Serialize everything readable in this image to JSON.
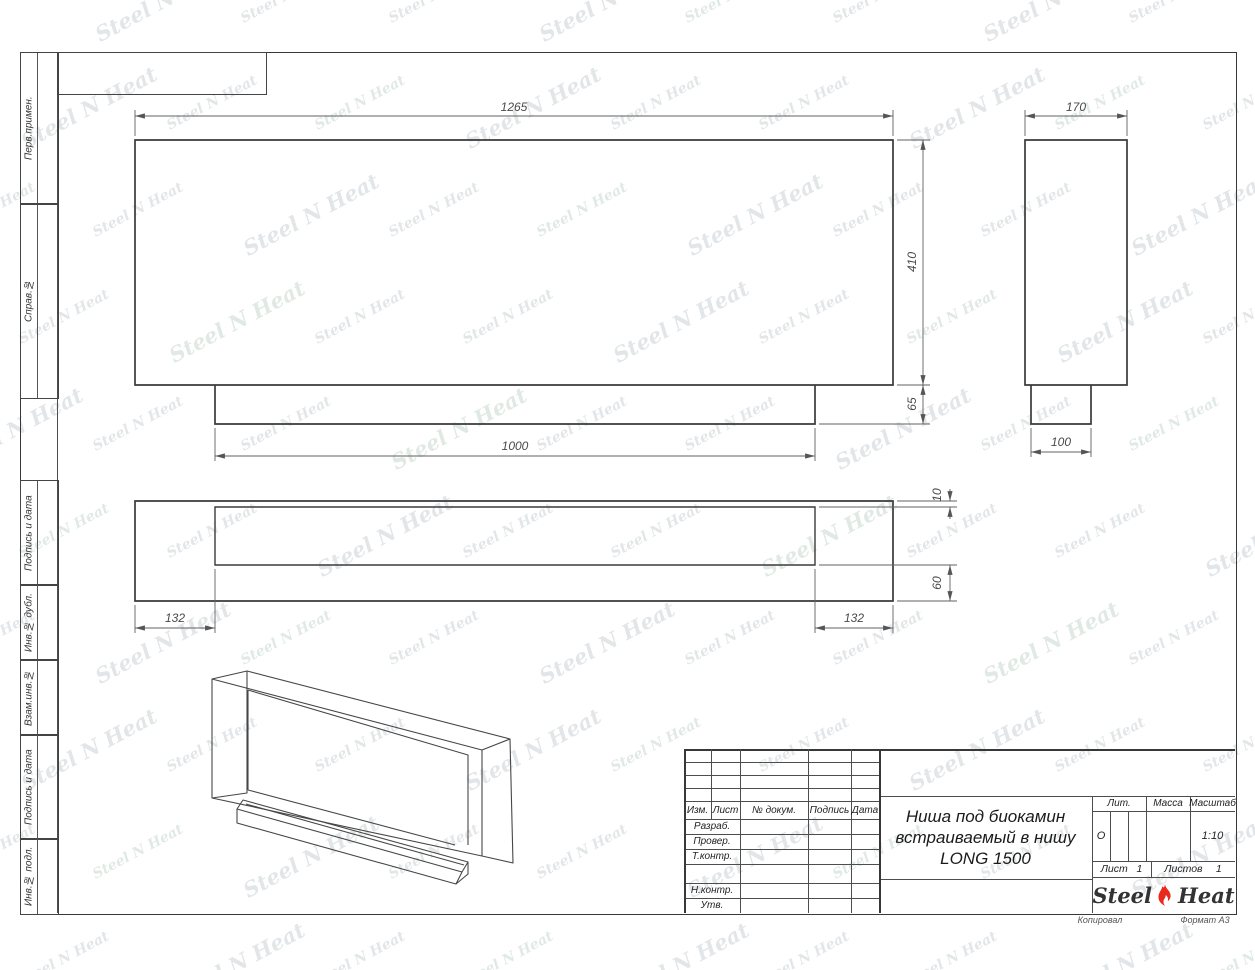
{
  "watermark": {
    "left": "Steel",
    "mark": "N",
    "right": "Heat",
    "colors": [
      "#a9b6ba",
      "#a3bfae"
    ]
  },
  "footer": {
    "copied": "Копировал",
    "format": "Формат А3"
  },
  "margin_labels": {
    "top": [
      "Перв.примен.",
      "Справ.№"
    ],
    "bottom": [
      "Подпись и дата",
      "Инв.№ дубл.",
      "Взам.инв.№",
      "Подпись и дата",
      "Инв.№ подл."
    ]
  },
  "dimensions": {
    "front_width": "1265",
    "front_height": "410",
    "tray_front_height": "65",
    "tray_front_width": "1000",
    "side_depth": "170",
    "side_tray_depth": "100",
    "plan_gap_front": "10",
    "plan_gap_back": "60",
    "plan_inset_left": "132",
    "plan_inset_right": "132"
  },
  "title_block": {
    "header_cols": [
      "Изм.",
      "Лист",
      "№ докум.",
      "Подпись",
      "Дата"
    ],
    "rows": [
      "Разраб.",
      "Провер.",
      "Т.контр.",
      "Н.контр.",
      "Утв."
    ],
    "title_lines": [
      "Ниша под биокамин",
      "встраиваемый в нишу",
      "LONG 1500"
    ],
    "lit_label": "Лит.",
    "lit_value": "О",
    "mass_label": "Масса",
    "scale_label": "Масштаб",
    "scale_value": "1:10",
    "sheet_label": "Лист",
    "sheet_value": "1",
    "sheets_label": "Листов",
    "sheets_value": "1",
    "logo": {
      "left": "Steel",
      "right": "Heat"
    }
  }
}
